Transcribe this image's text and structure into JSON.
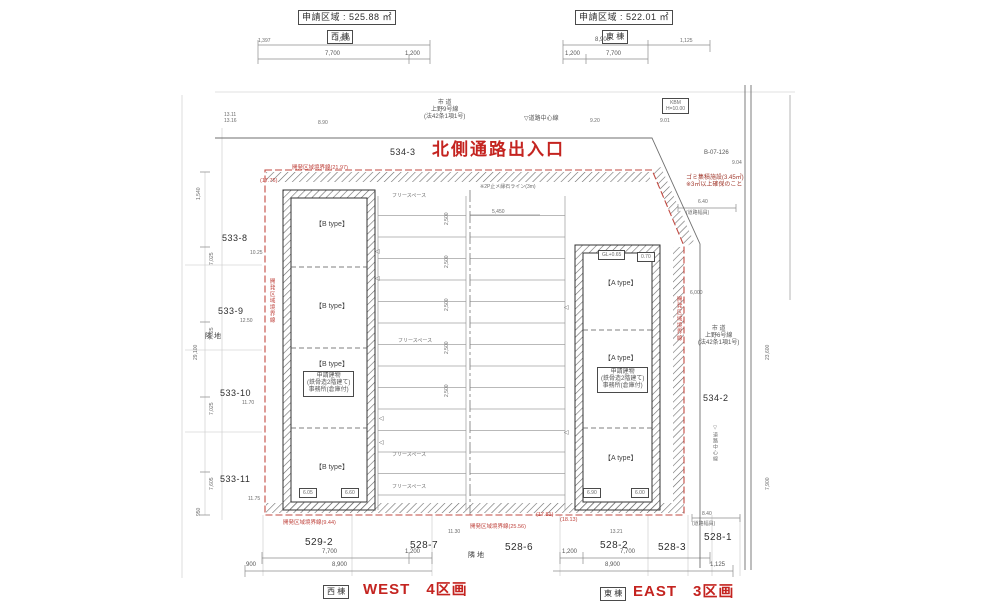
{
  "colors": {
    "accent_red": "#c42420",
    "boundary_red": "#c24a42",
    "line": "#4a4a4a"
  },
  "labels": [
    {
      "name": "west-area-label",
      "text": "申請区域 : 525.88 ㎡",
      "x": 298,
      "y": 10,
      "cls": "t9 box"
    },
    {
      "name": "west-wing-label",
      "text": "西 棟",
      "x": 327,
      "y": 30,
      "cls": "t8 box"
    },
    {
      "name": "east-area-label",
      "text": "申請区域 : 522.01 ㎡",
      "x": 575,
      "y": 10,
      "cls": "t9 box"
    },
    {
      "name": "east-wing-label",
      "text": "東 棟",
      "x": 602,
      "y": 30,
      "cls": "t8 box"
    },
    {
      "name": "dim-top-west-total",
      "text": "8,900",
      "x": 335,
      "y": 37,
      "cls": "t6"
    },
    {
      "name": "dim-top-west-left",
      "text": "1,397",
      "x": 258,
      "y": 38,
      "cls": "t5"
    },
    {
      "name": "dim-top-west-1",
      "text": "7,700",
      "x": 325,
      "y": 51,
      "cls": "t6"
    },
    {
      "name": "dim-top-west-2",
      "text": "1,200",
      "x": 405,
      "y": 51,
      "cls": "t6"
    },
    {
      "name": "dim-top-east-total",
      "text": "8,900",
      "x": 595,
      "y": 37,
      "cls": "t6"
    },
    {
      "name": "dim-top-east-right",
      "text": "1,125",
      "x": 680,
      "y": 38,
      "cls": "t5"
    },
    {
      "name": "dim-top-east-1",
      "text": "1,200",
      "x": 565,
      "y": 51,
      "cls": "t6"
    },
    {
      "name": "dim-top-east-2",
      "text": "7,700",
      "x": 606,
      "y": 51,
      "cls": "t6"
    },
    {
      "name": "north-road-name",
      "text": "市 道\n上野9号線\n(法42条1項1号)",
      "x": 424,
      "y": 100,
      "cls": "t6 pre c"
    },
    {
      "name": "north-road-centerline-label",
      "text": "▽道路中心線",
      "x": 524,
      "y": 116,
      "cls": "t6"
    },
    {
      "name": "spot-elev-1",
      "text": "8.90",
      "x": 318,
      "y": 120,
      "cls": "t5"
    },
    {
      "name": "spot-elev-2",
      "text": "9.20",
      "x": 590,
      "y": 118,
      "cls": "t5"
    },
    {
      "name": "spot-elev-3",
      "text": "9.01",
      "x": 660,
      "y": 118,
      "cls": "t5"
    },
    {
      "name": "spot-elev-nw",
      "text": "13.11\n13.16",
      "x": 224,
      "y": 112,
      "cls": "t5 pre"
    },
    {
      "name": "parcel-534-3",
      "text": "534-3",
      "x": 390,
      "y": 147,
      "cls": "t9"
    },
    {
      "name": "north-entrance-title",
      "text": "北側通路出入口",
      "x": 432,
      "y": 140,
      "cls": "red-big"
    },
    {
      "name": "kbm-box",
      "text": "KBM\nH=10.00",
      "x": 662,
      "y": 98,
      "cls": "t5 box pre c"
    },
    {
      "name": "benchmark-id",
      "text": "B-07-126",
      "x": 704,
      "y": 150,
      "cls": "t6"
    },
    {
      "name": "spot-elev-4",
      "text": "9.04",
      "x": 732,
      "y": 160,
      "cls": "t5"
    },
    {
      "name": "garbage-note",
      "text": "ゴミ集積施設(3.45㎡)\n※3㎡以上確保のこと",
      "x": 686,
      "y": 175,
      "cls": "maroon pre"
    },
    {
      "name": "road-width-dim-ne",
      "text": "6.40",
      "x": 698,
      "y": 199,
      "cls": "t5"
    },
    {
      "name": "road-width-label-ne",
      "text": "(道路幅員)",
      "x": 686,
      "y": 210,
      "cls": "t5"
    },
    {
      "name": "boundary-label-top",
      "text": "開発区域境界線(21.97)",
      "x": 292,
      "y": 165,
      "cls": "red-s"
    },
    {
      "name": "boundary-len-top-left",
      "text": "(17.76)",
      "x": 260,
      "y": 178,
      "cls": "red-s"
    },
    {
      "name": "curb-line-note",
      "text": "※2P止メ縁石ライン(3m)",
      "x": 480,
      "y": 184,
      "cls": "t5"
    },
    {
      "name": "parcel-533-8",
      "text": "533-8",
      "x": 222,
      "y": 233,
      "cls": "t9"
    },
    {
      "name": "elev-533-8",
      "text": "10.25",
      "x": 250,
      "y": 250,
      "cls": "t5"
    },
    {
      "name": "parcel-533-9",
      "text": "533-9",
      "x": 218,
      "y": 306,
      "cls": "t9"
    },
    {
      "name": "elev-533-9",
      "text": "12.50",
      "x": 240,
      "y": 318,
      "cls": "t5"
    },
    {
      "name": "neighbor-land-west",
      "text": "隣 地",
      "x": 205,
      "y": 333,
      "cls": "t7"
    },
    {
      "name": "parcel-533-10",
      "text": "533-10",
      "x": 220,
      "y": 388,
      "cls": "t9"
    },
    {
      "name": "elev-533-10",
      "text": "11.70",
      "x": 242,
      "y": 400,
      "cls": "t5"
    },
    {
      "name": "parcel-533-11",
      "text": "533-11",
      "x": 220,
      "y": 474,
      "cls": "t9"
    },
    {
      "name": "elev-533-11",
      "text": "11.75",
      "x": 248,
      "y": 496,
      "cls": "t5"
    },
    {
      "name": "dim-left-1",
      "text": "1,540",
      "x": 196,
      "y": 200,
      "cls": "t5 rot"
    },
    {
      "name": "dim-left-2",
      "text": "7,025",
      "x": 209,
      "y": 265,
      "cls": "t5 rot"
    },
    {
      "name": "dim-left-3",
      "text": "7,025",
      "x": 209,
      "y": 340,
      "cls": "t5 rot"
    },
    {
      "name": "dim-left-4",
      "text": "7,025",
      "x": 209,
      "y": 415,
      "cls": "t5 rot"
    },
    {
      "name": "dim-left-5",
      "text": "7,605",
      "x": 209,
      "y": 490,
      "cls": "t5 rot"
    },
    {
      "name": "dim-left-total",
      "text": "29,100",
      "x": 193,
      "y": 360,
      "cls": "t5 rot"
    },
    {
      "name": "dim-left-6",
      "text": "950",
      "x": 196,
      "y": 516,
      "cls": "t5 rot"
    },
    {
      "name": "boundary-label-left",
      "text": "開発区域境界線",
      "x": 268,
      "y": 278,
      "cls": "red-s rotv"
    },
    {
      "name": "unit-b1-label",
      "text": "【B type】",
      "x": 315,
      "y": 221,
      "cls": "t7"
    },
    {
      "name": "unit-b2-label",
      "text": "【B type】",
      "x": 315,
      "y": 303,
      "cls": "t7"
    },
    {
      "name": "unit-b3-label",
      "text": "【B type】",
      "x": 315,
      "y": 361,
      "cls": "t7"
    },
    {
      "name": "west-building-note",
      "text": "申請建物\n(鉄骨造2階建て)\n事務所(倉庫付)",
      "x": 303,
      "y": 371,
      "cls": "t6 box pre c"
    },
    {
      "name": "unit-b4-label",
      "text": "【B type】",
      "x": 315,
      "y": 464,
      "cls": "t7"
    },
    {
      "name": "gl-box-w1",
      "text": "6.05",
      "x": 299,
      "y": 488,
      "cls": "t5 box"
    },
    {
      "name": "gl-box-w2",
      "text": "6.60",
      "x": 341,
      "y": 488,
      "cls": "t5 box"
    },
    {
      "name": "free-space-1",
      "text": "フリースペース",
      "x": 392,
      "y": 193,
      "cls": "t5"
    },
    {
      "name": "free-space-2",
      "text": "フリースペース",
      "x": 398,
      "y": 338,
      "cls": "t5"
    },
    {
      "name": "free-space-3",
      "text": "フリースペース",
      "x": 392,
      "y": 452,
      "cls": "t5"
    },
    {
      "name": "free-space-4",
      "text": "フリースペース",
      "x": 392,
      "y": 484,
      "cls": "t5"
    },
    {
      "name": "stall-dim-1",
      "text": "2,500",
      "x": 444,
      "y": 225,
      "cls": "t5 rot"
    },
    {
      "name": "stall-dim-2",
      "text": "2,500",
      "x": 444,
      "y": 268,
      "cls": "t5 rot"
    },
    {
      "name": "stall-dim-3",
      "text": "2,500",
      "x": 444,
      "y": 311,
      "cls": "t5 rot"
    },
    {
      "name": "stall-dim-4",
      "text": "2,500",
      "x": 444,
      "y": 354,
      "cls": "t5 rot"
    },
    {
      "name": "stall-dim-5",
      "text": "2,500",
      "x": 444,
      "y": 397,
      "cls": "t5 rot"
    },
    {
      "name": "aisle-dim",
      "text": "5,450",
      "x": 492,
      "y": 209,
      "cls": "t5"
    },
    {
      "name": "door-marker-icon-1",
      "text": "◁",
      "x": 375,
      "y": 249,
      "cls": "t6"
    },
    {
      "name": "door-marker-icon-2",
      "text": "◁",
      "x": 375,
      "y": 276,
      "cls": "t6"
    },
    {
      "name": "door-marker-icon-3",
      "text": "◁",
      "x": 379,
      "y": 416,
      "cls": "t6"
    },
    {
      "name": "door-marker-icon-4",
      "text": "◁",
      "x": 379,
      "y": 440,
      "cls": "t6"
    },
    {
      "name": "door-marker-icon-5",
      "text": "◁",
      "x": 564,
      "y": 305,
      "cls": "t6"
    },
    {
      "name": "door-marker-icon-6",
      "text": "◁",
      "x": 564,
      "y": 430,
      "cls": "t6"
    },
    {
      "name": "gl-box-e-top",
      "text": "GL+0.65",
      "x": 598,
      "y": 250,
      "cls": "t5 box"
    },
    {
      "name": "gl-box-e-top2",
      "text": "0.70",
      "x": 637,
      "y": 252,
      "cls": "t5 box"
    },
    {
      "name": "unit-a1-label",
      "text": "【A type】",
      "x": 604,
      "y": 280,
      "cls": "t7"
    },
    {
      "name": "unit-a2-label",
      "text": "【A type】",
      "x": 604,
      "y": 355,
      "cls": "t7"
    },
    {
      "name": "east-building-note",
      "text": "申請建物\n(鉄骨造2階建て)\n事務所(倉庫付)",
      "x": 597,
      "y": 367,
      "cls": "t6 box pre c"
    },
    {
      "name": "unit-a3-label",
      "text": "【A type】",
      "x": 604,
      "y": 455,
      "cls": "t7"
    },
    {
      "name": "gl-box-e1",
      "text": "6.90",
      "x": 583,
      "y": 488,
      "cls": "t5 box"
    },
    {
      "name": "gl-box-e2",
      "text": "6.00",
      "x": 631,
      "y": 488,
      "cls": "t5 box"
    },
    {
      "name": "boundary-label-right",
      "text": "開発区域境界線",
      "x": 675,
      "y": 296,
      "cls": "red-s rotv"
    },
    {
      "name": "dim-east-6000",
      "text": "6,000",
      "x": 690,
      "y": 290,
      "cls": "t5"
    },
    {
      "name": "east-road-name",
      "text": "市 道\n上野6号線\n(法42条1項1号)",
      "x": 698,
      "y": 326,
      "cls": "t6 pre c"
    },
    {
      "name": "parcel-534-2",
      "text": "534-2",
      "x": 703,
      "y": 393,
      "cls": "t9"
    },
    {
      "name": "east-road-centerline-label",
      "text": "▽道路中心線",
      "x": 712,
      "y": 425,
      "cls": "t5 rotv"
    },
    {
      "name": "dim-right-1",
      "text": "23,600",
      "x": 765,
      "y": 360,
      "cls": "t5 rot"
    },
    {
      "name": "dim-right-2",
      "text": "7,900",
      "x": 765,
      "y": 490,
      "cls": "t5 rot"
    },
    {
      "name": "boundary-label-bottom-left",
      "text": "開発区域境界線(9.44)",
      "x": 283,
      "y": 520,
      "cls": "red-s"
    },
    {
      "name": "boundary-len-bottom-1",
      "text": "(17.81)",
      "x": 536,
      "y": 512,
      "cls": "red-s"
    },
    {
      "name": "boundary-len-bottom-2",
      "text": "(18.13)",
      "x": 560,
      "y": 517,
      "cls": "red-s"
    },
    {
      "name": "boundary-label-bottom-right",
      "text": "開発区域境界線(25.56)",
      "x": 470,
      "y": 524,
      "cls": "red-s"
    },
    {
      "name": "parcel-529-2",
      "text": "529-2",
      "x": 305,
      "y": 537,
      "cls": "t10"
    },
    {
      "name": "parcel-528-7",
      "text": "528-7",
      "x": 410,
      "y": 540,
      "cls": "t10"
    },
    {
      "name": "parcel-528-6",
      "text": "528-6",
      "x": 505,
      "y": 542,
      "cls": "t10"
    },
    {
      "name": "parcel-528-2",
      "text": "528-2",
      "x": 600,
      "y": 540,
      "cls": "t10"
    },
    {
      "name": "parcel-528-3",
      "text": "528-3",
      "x": 658,
      "y": 542,
      "cls": "t10"
    },
    {
      "name": "parcel-528-1",
      "text": "528-1",
      "x": 704,
      "y": 532,
      "cls": "t10"
    },
    {
      "name": "elev-b1",
      "text": "11.30",
      "x": 448,
      "y": 529,
      "cls": "t5"
    },
    {
      "name": "elev-b2",
      "text": "13.21",
      "x": 610,
      "y": 529,
      "cls": "t5"
    },
    {
      "name": "road-width-dim-se",
      "text": "8.40",
      "x": 702,
      "y": 511,
      "cls": "t5"
    },
    {
      "name": "road-width-label-se",
      "text": "(道路幅員)",
      "x": 692,
      "y": 521,
      "cls": "t5"
    },
    {
      "name": "neighbor-land-bottom",
      "text": "隣 地",
      "x": 468,
      "y": 552,
      "cls": "t7"
    },
    {
      "name": "dim-bot-west-1",
      "text": "7,700",
      "x": 322,
      "y": 549,
      "cls": "t6"
    },
    {
      "name": "dim-bot-west-2",
      "text": "1,200",
      "x": 405,
      "y": 549,
      "cls": "t6"
    },
    {
      "name": "dim-bot-west-3",
      "text": "900",
      "x": 246,
      "y": 562,
      "cls": "t6"
    },
    {
      "name": "dim-bot-west-total",
      "text": "8,900",
      "x": 332,
      "y": 562,
      "cls": "t6"
    },
    {
      "name": "dim-bot-east-1",
      "text": "1,200",
      "x": 562,
      "y": 549,
      "cls": "t6"
    },
    {
      "name": "dim-bot-east-2",
      "text": "7,700",
      "x": 620,
      "y": 549,
      "cls": "t6"
    },
    {
      "name": "dim-bot-east-total",
      "text": "8,900",
      "x": 605,
      "y": 562,
      "cls": "t6"
    },
    {
      "name": "dim-bot-east-3",
      "text": "1,125",
      "x": 710,
      "y": 562,
      "cls": "t6"
    },
    {
      "name": "west-wing-caption",
      "text": "西 棟",
      "x": 323,
      "y": 585,
      "cls": "t8 box"
    },
    {
      "name": "west-caption",
      "text": "WEST　4区画",
      "x": 363,
      "y": 581,
      "cls": "red-cap"
    },
    {
      "name": "east-wing-caption",
      "text": "東 棟",
      "x": 600,
      "y": 587,
      "cls": "t8 box"
    },
    {
      "name": "east-caption",
      "text": "EAST　3区画",
      "x": 633,
      "y": 583,
      "cls": "red-cap"
    }
  ]
}
